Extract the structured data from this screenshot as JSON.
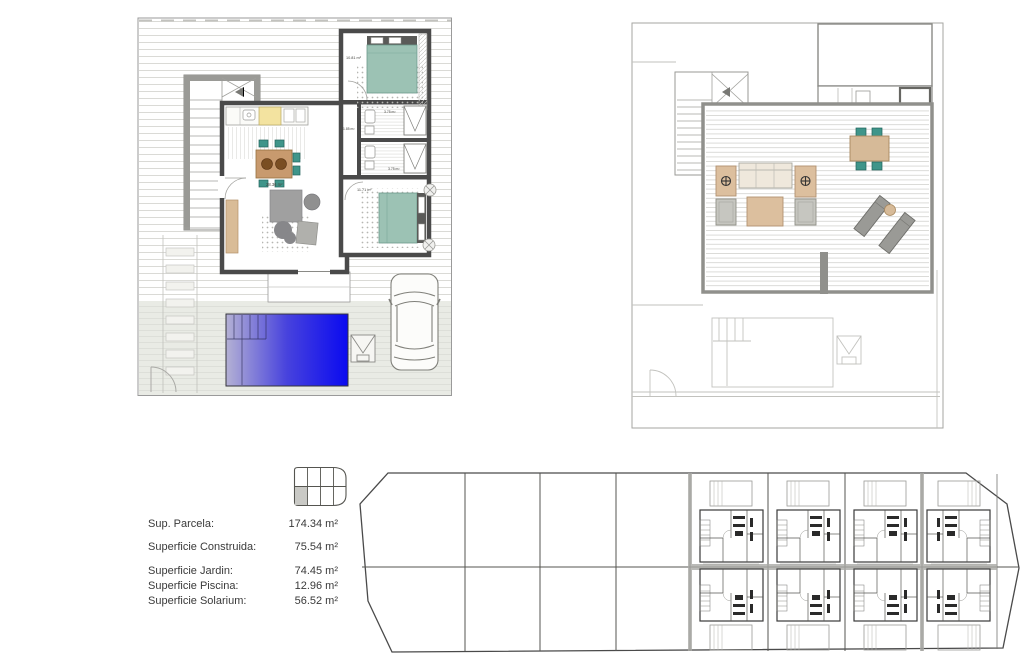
{
  "legend": {
    "rows": [
      {
        "label": "Sup. Parcela:",
        "value": "174.34 m²"
      },
      {
        "label": "Superficie Construida:",
        "value": "75.54 m²"
      },
      {
        "label": "Superficie Jardin:",
        "value": "74.45 m²"
      },
      {
        "label": "Superficie Piscina:",
        "value": "12.96 m²"
      },
      {
        "label": "Superficie Solarium:",
        "value": "56.52 m²"
      }
    ]
  },
  "plans": {
    "ground_floor": {
      "room_labels": [
        {
          "room": "bedroom-1",
          "text": "10.81 m²"
        },
        {
          "room": "hallway",
          "text": "1.85 m²"
        },
        {
          "room": "bathroom-1",
          "text": "3.75 m²"
        },
        {
          "room": "bathroom-2",
          "text": "3.75 m²"
        },
        {
          "room": "living-kitchen",
          "text": "28.36 m²"
        },
        {
          "room": "bedroom-2",
          "text": "11.71 m²"
        }
      ]
    }
  },
  "colors": {
    "pool_gradient_start": "#b4b1d4",
    "pool_gradient_mid": "#4742dd",
    "pool_gradient_end": "#0a0af0",
    "bed_teal": "#9cc2b4",
    "chair_teal": "#3f958a",
    "wood_tan": "#d6ba98",
    "wall_dark": "#4a4a4a",
    "wall_mid": "#90908c",
    "terrace": "#e9ebe5"
  }
}
